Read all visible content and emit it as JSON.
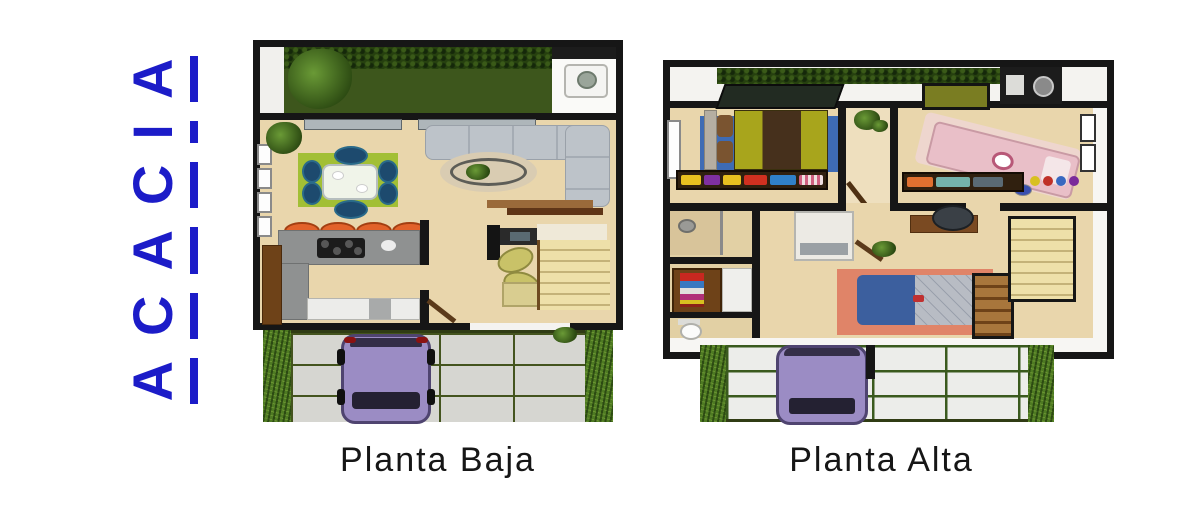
{
  "brand": {
    "name": "ACACIA",
    "letters": [
      "A",
      "C",
      "A",
      "C",
      "I",
      "A"
    ],
    "color": "#1c1cc8"
  },
  "plans": {
    "ground": {
      "label": "Planta Baja"
    },
    "upper": {
      "label": "Planta Alta"
    }
  },
  "colors": {
    "brand_blue": "#1c1cc8",
    "caption_text": "#161616",
    "wall_black": "#161616",
    "wood_floor": "#e9d6ac",
    "garden_grass": "#3d561c",
    "hedge_green": "#26400f",
    "lawn_strip": "#4e7a22",
    "driveway_concrete": "#d6d6d1",
    "driveway_grid_line": "#44541e",
    "car_purple": "#9b8cc4",
    "dining_rug_green": "#a2bf35",
    "dining_chair_navy": "#1d4a6e",
    "sofa_gray": "#bdc3c9",
    "kitchen_counter_gray": "#8f9191",
    "stool_orange": "#e2622a",
    "stairs_tan": "#eee0a9",
    "bedroom1_rug_blue": "#3e6bb4",
    "bed1_olive": "#a8a51c",
    "bed1_brown": "#46301c",
    "bed2_pink": "#e9bfc8",
    "bed3_rug_coral": "#e08468",
    "bed3_blanket_blue": "#3c5f9e"
  }
}
